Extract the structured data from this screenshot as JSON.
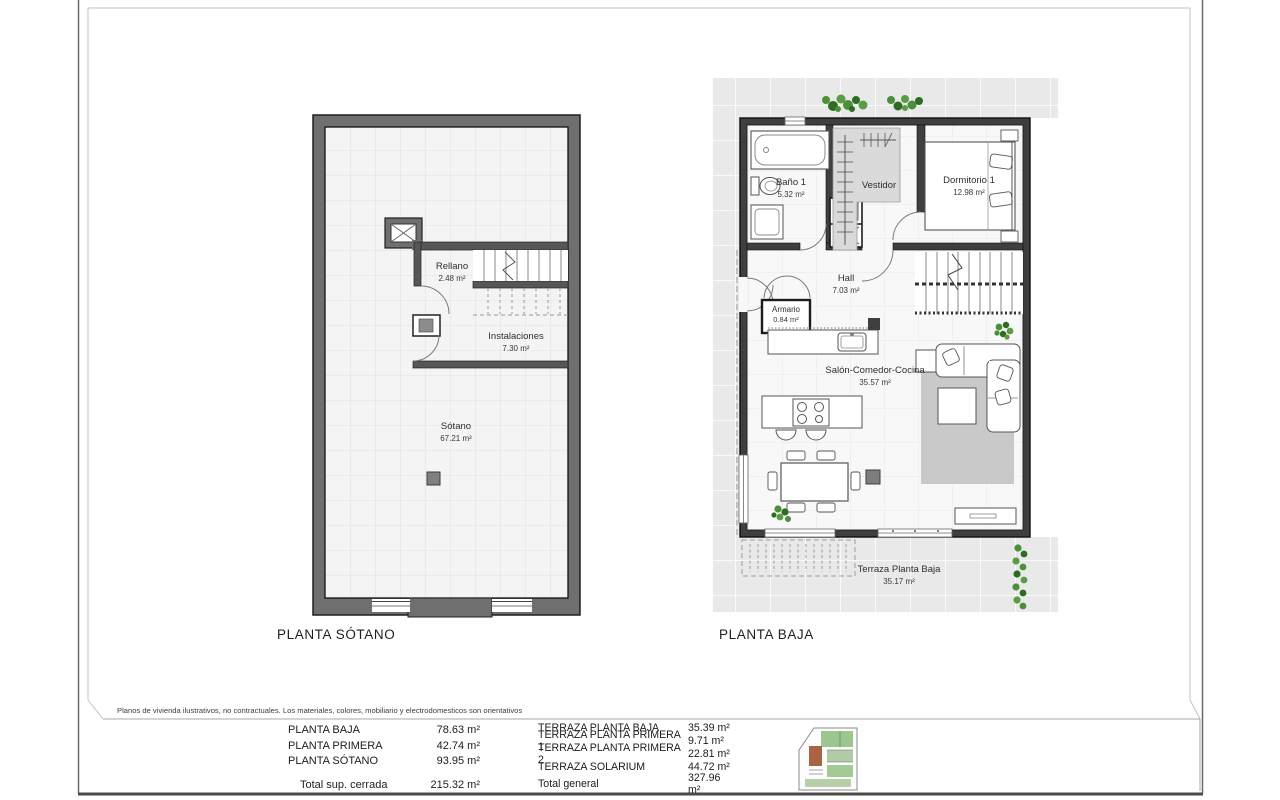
{
  "disclaimer": "Planos de vivienda ilustrativos, no contractuales. Los materiales, colores, mobiliario y electrodomesticos son orientativos",
  "plans": {
    "sotano": {
      "title": "PLANTA SÓTANO",
      "rooms": {
        "rellano": {
          "name": "Rellano",
          "area": "2.48 m²"
        },
        "instalaciones": {
          "name": "Instalaciones",
          "area": "7.30 m²"
        },
        "sotano": {
          "name": "Sótano",
          "area": "67.21 m²"
        }
      }
    },
    "baja": {
      "title": "PLANTA BAJA",
      "rooms": {
        "bano1": {
          "name": "Baño 1",
          "area": "5.32 m²"
        },
        "vestidor": {
          "name": "Vestidor"
        },
        "dormitorio1": {
          "name": "Dormitorio 1",
          "area": "12.98 m²"
        },
        "hall": {
          "name": "Hall",
          "area": "7.03 m²"
        },
        "armario": {
          "name": "Armario",
          "area": "0.84 m²"
        },
        "salon": {
          "name": "Salón-Comedor-Cocina",
          "area": "35.57 m²"
        },
        "terraza": {
          "name": "Terraza Planta Baja",
          "area": "35.17 m²"
        }
      }
    }
  },
  "summary": {
    "closed": {
      "rows": [
        {
          "label": "PLANTA BAJA",
          "value": "78.63 m²"
        },
        {
          "label": "PLANTA PRIMERA",
          "value": "42.74 m²"
        },
        {
          "label": "PLANTA SÓTANO",
          "value": "93.95 m²"
        }
      ],
      "total_label": "Total sup. cerrada",
      "total_value": "215.32 m²"
    },
    "terraces": {
      "rows": [
        {
          "label": "TERRAZA PLANTA BAJA",
          "value": "35.39 m²"
        },
        {
          "label": "TERRAZA PLANTA PRIMERA 1",
          "value": "9.71 m²"
        },
        {
          "label": "TERRAZA PLANTA PRIMERA 2",
          "value": "22.81 m²"
        },
        {
          "label": "TERRAZA SOLARIUM",
          "value": "44.72 m²"
        }
      ],
      "total_label": "Total general",
      "total_value": "327.96 m²"
    }
  },
  "colors": {
    "wall_dark": "#3f3f3f",
    "wall_gray": "#6f6f6f",
    "rug_gray": "#c9c9c9",
    "plant_green": "#4c8f3a",
    "tile_base": "#e9e9e9",
    "plot_brown": "#a0522d"
  }
}
